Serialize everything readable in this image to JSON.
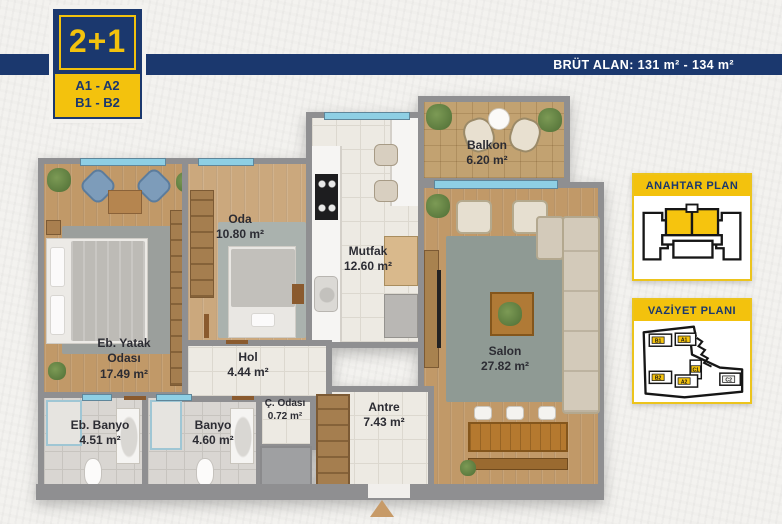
{
  "badge": {
    "unit_type": "2+1",
    "codes": [
      "A1 - A2",
      "B1 - B2"
    ]
  },
  "header": {
    "brut_alan": "BRÜT ALAN: 131 m² - 134 m²"
  },
  "rooms": {
    "balkon": {
      "name": "Balkon",
      "area": "6.20 m²"
    },
    "oda": {
      "name": "Oda",
      "area": "10.80 m²"
    },
    "mutfak": {
      "name": "Mutfak",
      "area": "12.60 m²"
    },
    "salon": {
      "name": "Salon",
      "area": "27.82 m²"
    },
    "eb_yatak": {
      "name": "Eb. Yatak Odası",
      "area": "17.49 m²"
    },
    "hol": {
      "name": "Hol",
      "area": "4.44 m²"
    },
    "eb_banyo": {
      "name": "Eb. Banyo",
      "area": "4.51 m²"
    },
    "banyo": {
      "name": "Banyo",
      "area": "4.60 m²"
    },
    "c_odasi": {
      "name": "Ç. Odası",
      "area": "0.72 m²"
    },
    "antre": {
      "name": "Antre",
      "area": "7.43 m²"
    }
  },
  "panels": {
    "anahtar": {
      "title": "ANAHTAR PLAN"
    },
    "vaziyet": {
      "title": "VAZİYET PLANI",
      "blocks": [
        "B1",
        "A1",
        "C1",
        "B2",
        "A2",
        "C2"
      ]
    }
  },
  "colors": {
    "navy": "#1b386e",
    "yellow": "#f3c20d",
    "wall_gray": "#8f8f91",
    "window_blue": "#8ecfe4",
    "entrance_arrow": "#c79a67"
  }
}
